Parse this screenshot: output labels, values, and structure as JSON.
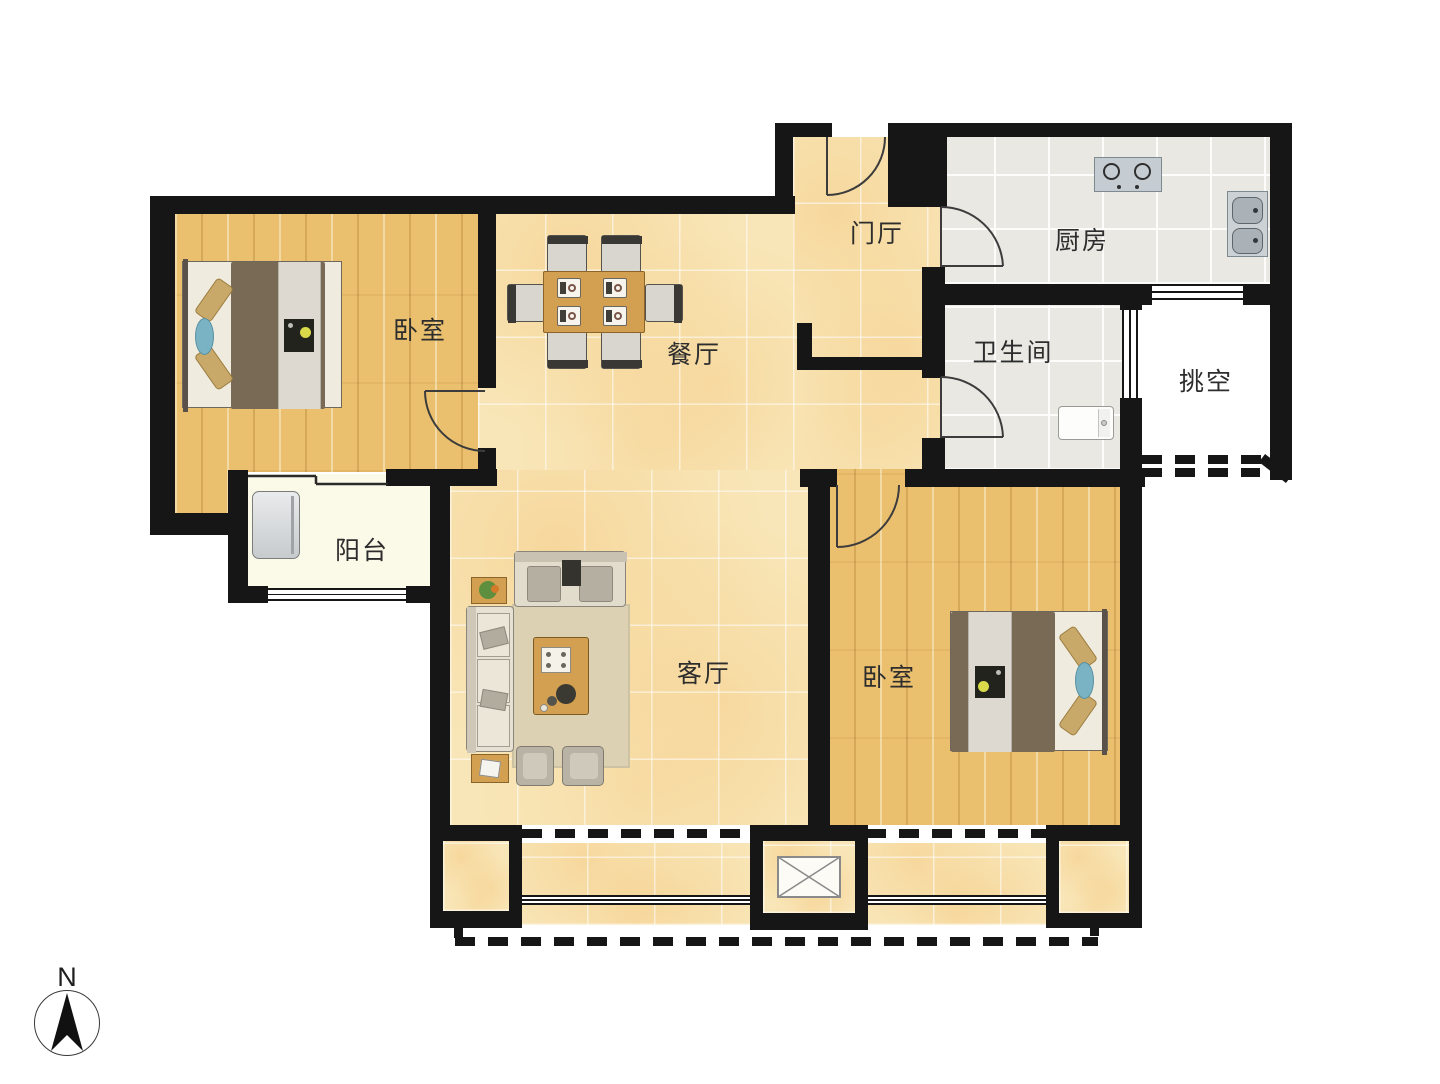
{
  "compass": {
    "label": "N"
  },
  "rooms": {
    "bedroom_nw": {
      "label": "卧室"
    },
    "dining": {
      "label": "餐厅"
    },
    "foyer": {
      "label": "门厅"
    },
    "kitchen": {
      "label": "厨房"
    },
    "bathroom": {
      "label": "卫生间"
    },
    "void": {
      "label": "挑空"
    },
    "balcony_west": {
      "label": "阳台"
    },
    "living": {
      "label": "客厅"
    },
    "bedroom_se": {
      "label": "卧室"
    }
  },
  "palette": {
    "wall": "#161616",
    "wood_floor": "#eac06f",
    "marble_floor": "#f8e6b8",
    "gray_tile": "#e9e8e3",
    "balcony_floor": "#fbf9e7",
    "furniture_wood": "#d2a050",
    "duvet_brown": "#796a55",
    "pillow_tan": "#c9a96a",
    "pillow_blue": "#7ab3c4"
  }
}
